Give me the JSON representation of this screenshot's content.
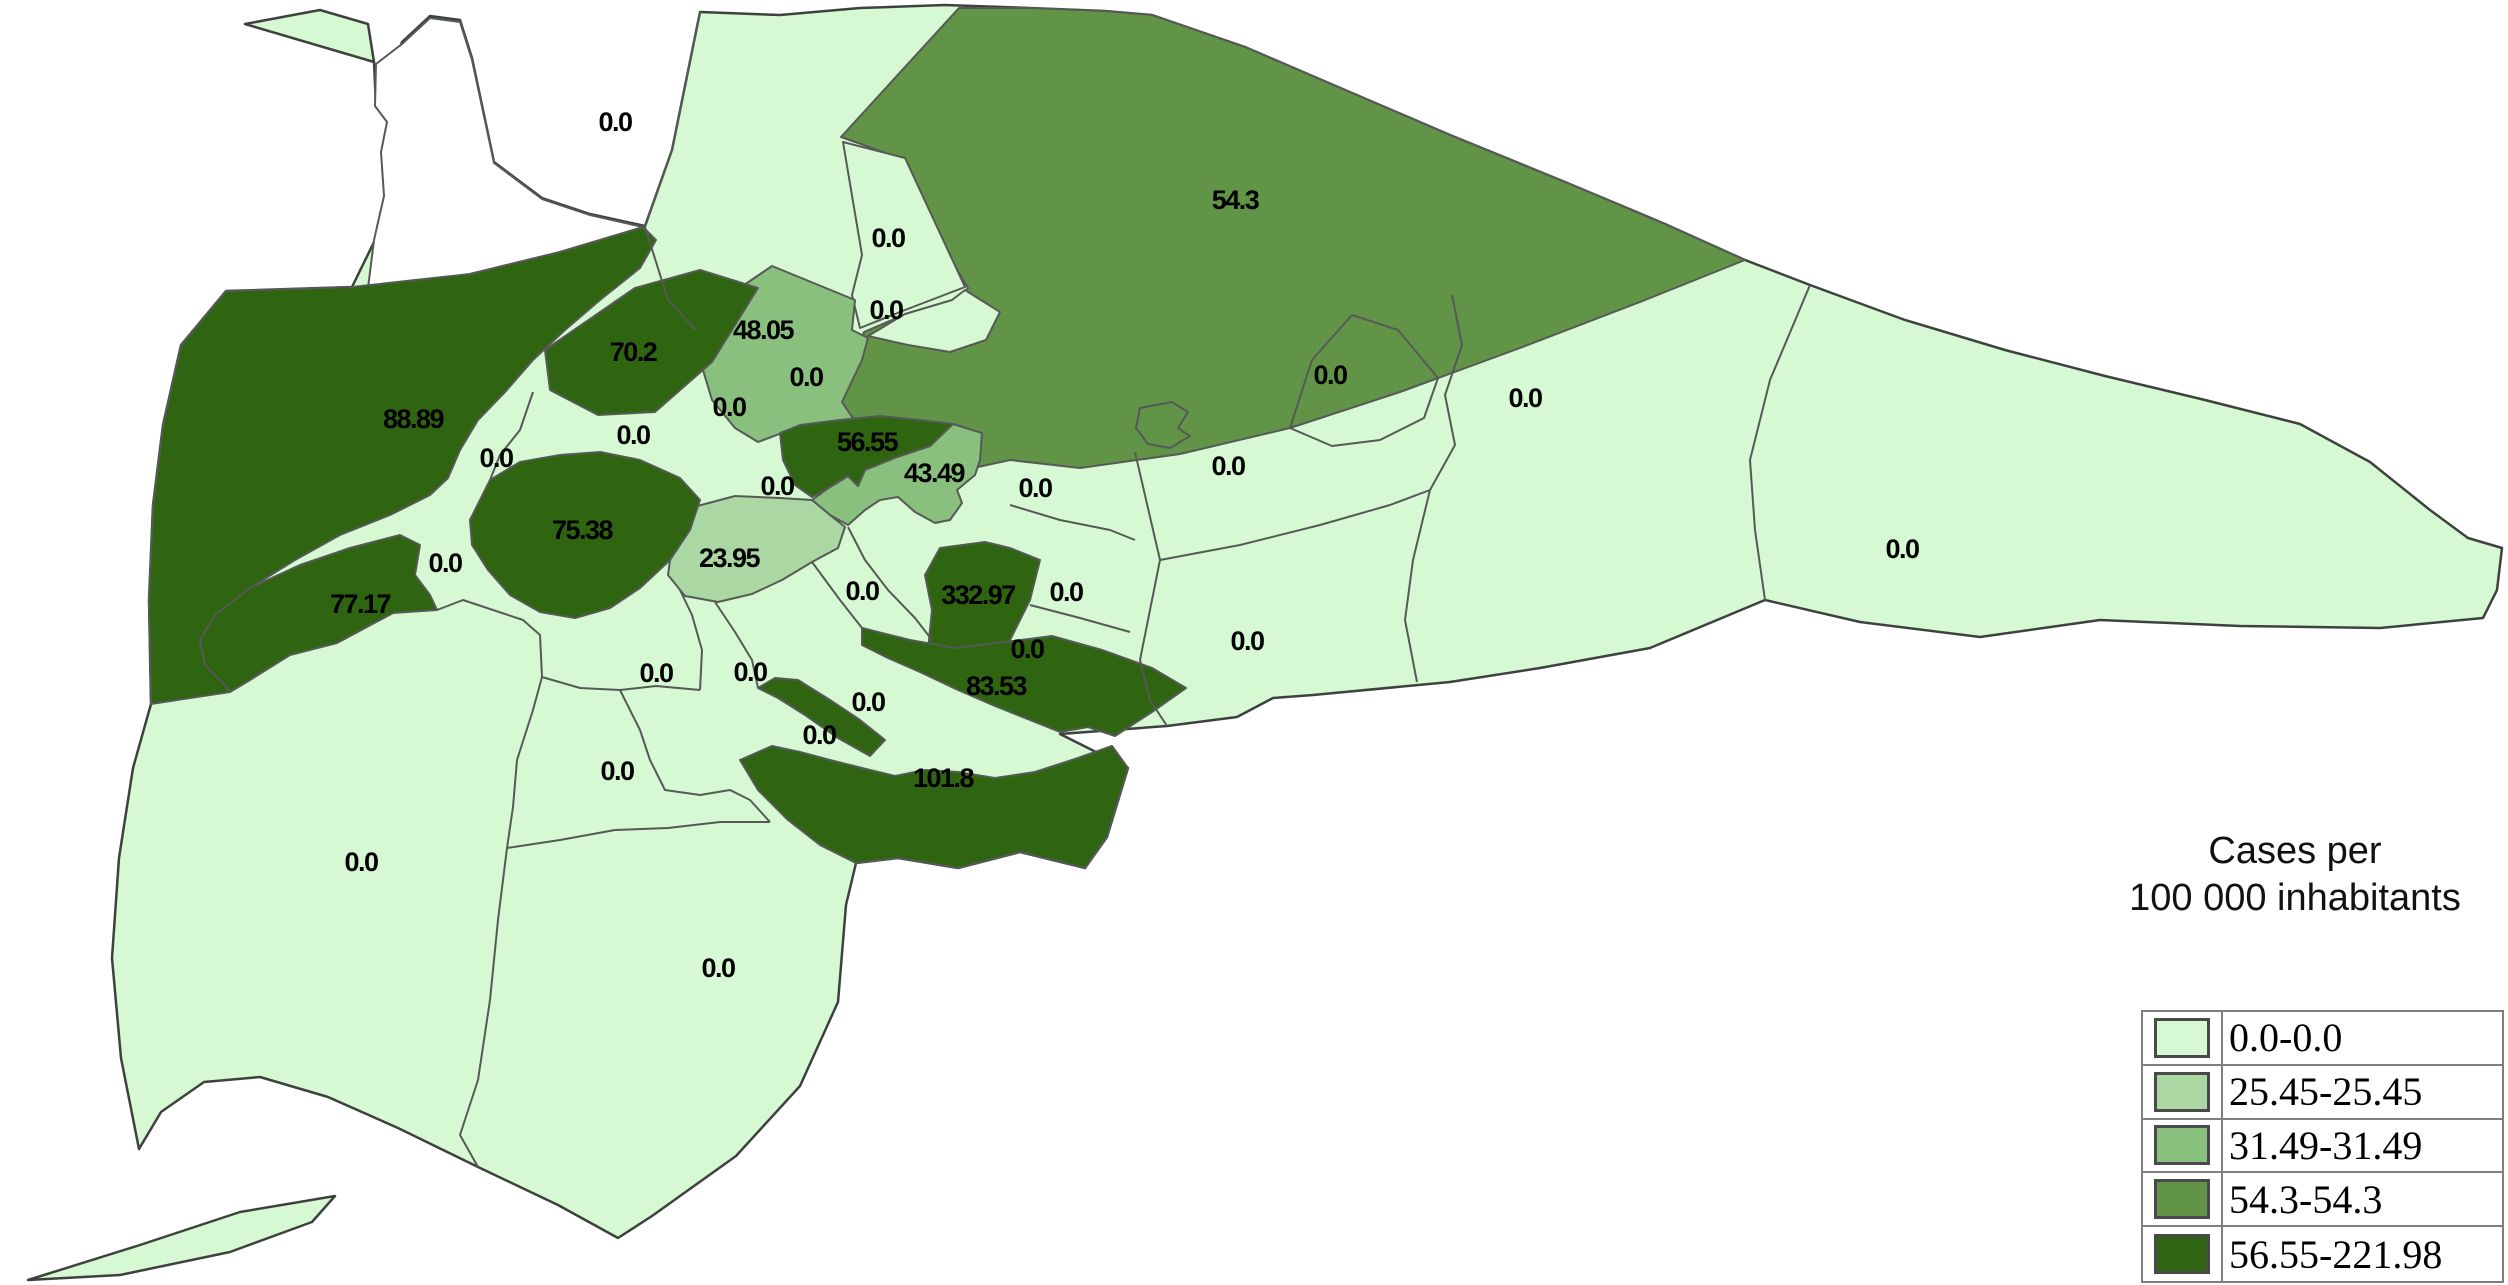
{
  "header": {
    "title_line1": "Cases per",
    "title_line2": "100 000 inhabitants"
  },
  "legend": {
    "classes": [
      {
        "range": "0.0-0.0",
        "color": "#d6f9d3"
      },
      {
        "range": "25.45-25.45",
        "color": "#abd8a2"
      },
      {
        "range": "31.49-31.49",
        "color": "#8ac07e"
      },
      {
        "range": "54.3-54.3",
        "color": "#629447"
      },
      {
        "range": "56.55-221.98",
        "color": "#2f6410"
      }
    ]
  },
  "map": {
    "labels": [
      {
        "v": "0.0",
        "x": 615,
        "y": 122
      },
      {
        "v": "54.3",
        "x": 1235,
        "y": 200
      },
      {
        "v": "0.0",
        "x": 888,
        "y": 238
      },
      {
        "v": "0.0",
        "x": 886,
        "y": 310
      },
      {
        "v": "70.2",
        "x": 633,
        "y": 352
      },
      {
        "v": "48.05",
        "x": 763,
        "y": 330
      },
      {
        "v": "0.0",
        "x": 806,
        "y": 377
      },
      {
        "v": "0.0",
        "x": 729,
        "y": 407
      },
      {
        "v": "88.89",
        "x": 413,
        "y": 419
      },
      {
        "v": "0.0",
        "x": 496,
        "y": 458
      },
      {
        "v": "0.0",
        "x": 633,
        "y": 435
      },
      {
        "v": "56.55",
        "x": 867,
        "y": 442
      },
      {
        "v": "43.49",
        "x": 934,
        "y": 473
      },
      {
        "v": "0.0",
        "x": 1035,
        "y": 488
      },
      {
        "v": "0.0",
        "x": 777,
        "y": 486
      },
      {
        "v": "0.0",
        "x": 1228,
        "y": 466
      },
      {
        "v": "0.0",
        "x": 1330,
        "y": 375
      },
      {
        "v": "0.0",
        "x": 1525,
        "y": 398
      },
      {
        "v": "75.38",
        "x": 582,
        "y": 530
      },
      {
        "v": "23.95",
        "x": 729,
        "y": 558
      },
      {
        "v": "0.0",
        "x": 445,
        "y": 563
      },
      {
        "v": "77.17",
        "x": 360,
        "y": 604
      },
      {
        "v": "0.0",
        "x": 862,
        "y": 591
      },
      {
        "v": "332.97",
        "x": 978,
        "y": 595
      },
      {
        "v": "0.0",
        "x": 1066,
        "y": 592
      },
      {
        "v": "0.0",
        "x": 1027,
        "y": 649
      },
      {
        "v": "0.0",
        "x": 1247,
        "y": 641
      },
      {
        "v": "0.0",
        "x": 1902,
        "y": 549
      },
      {
        "v": "0.0",
        "x": 656,
        "y": 673
      },
      {
        "v": "0.0",
        "x": 750,
        "y": 672
      },
      {
        "v": "0.0",
        "x": 868,
        "y": 702
      },
      {
        "v": "83.53",
        "x": 996,
        "y": 686
      },
      {
        "v": "0.0",
        "x": 819,
        "y": 735
      },
      {
        "v": "101.8",
        "x": 943,
        "y": 778
      },
      {
        "v": "0.0",
        "x": 617,
        "y": 771
      },
      {
        "v": "0.0",
        "x": 361,
        "y": 862
      },
      {
        "v": "0.0",
        "x": 718,
        "y": 968
      }
    ]
  },
  "colors": {
    "border": "#565a56",
    "outer_border": "#3e423e",
    "background": "#ffffff",
    "label_text": "#000000",
    "legend_border": "#7f7f7f",
    "swatch_border": "#4a4a4a"
  }
}
